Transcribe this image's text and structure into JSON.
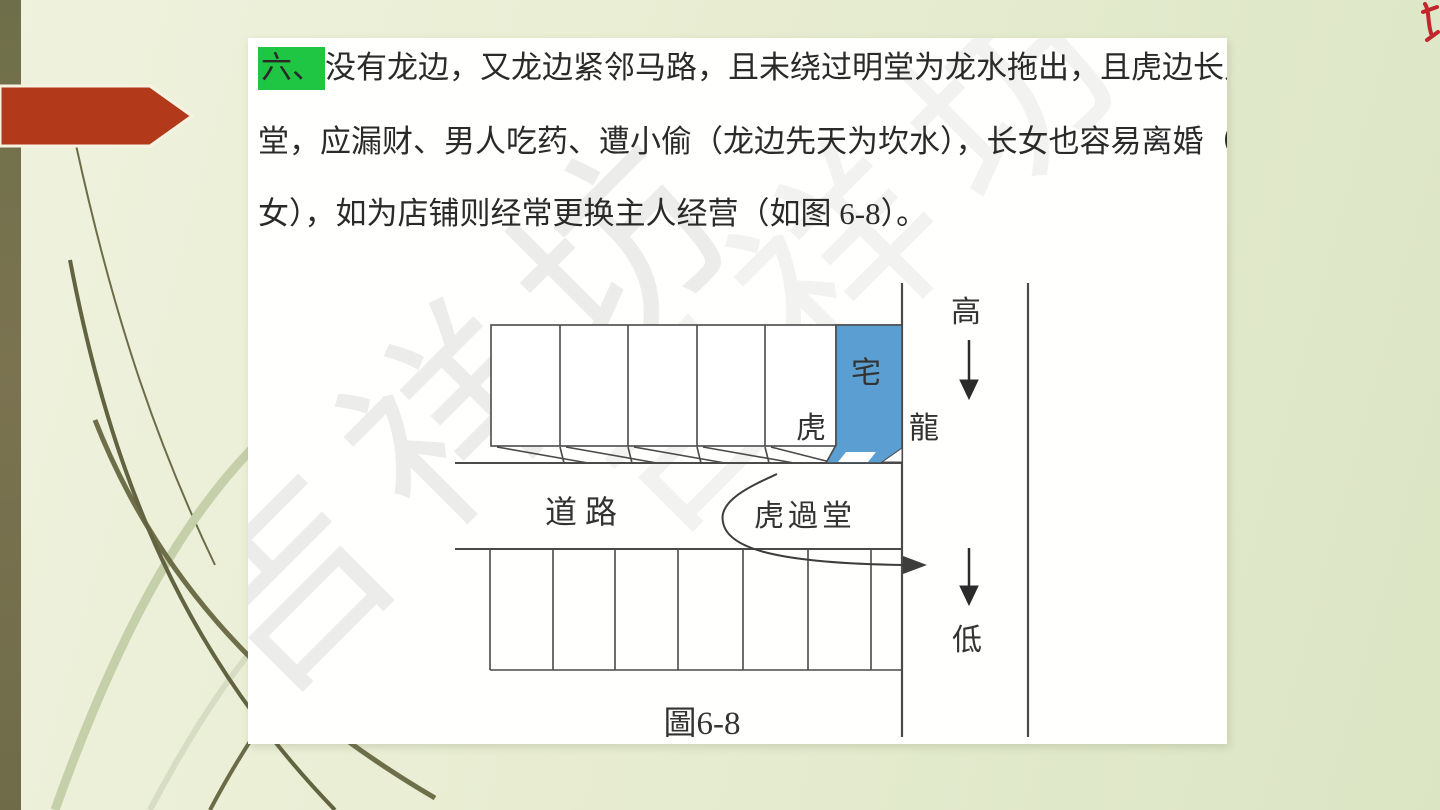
{
  "slide": {
    "type": "presentation-slide",
    "colors": {
      "background": "#e8edd2",
      "sidebar_bar": "#73734d",
      "accent_arrow": "#b23a1b",
      "panel": "#fffffd",
      "highlight_green": "#1fc643",
      "house_blue": "#5b9ed1",
      "body_text": "#2a2a2a",
      "diagram_line": "#4a4a4a",
      "watermark_gray": "#c9c9c9",
      "watermark_red": "#c1272d"
    }
  },
  "paragraph": {
    "highlight_text": "六、",
    "line1_rest": "没有龙边，又龙边紧邻马路，且未绕过明堂为龙水拖出，且虎边长又虎过",
    "line2": "堂，应漏财、男人吃药、遭小偷（龙边先天为坎水），长女也容易离婚（低论",
    "line3": "女），如为店铺则经常更换主人经营（如图 6-8）。"
  },
  "diagram": {
    "labels": {
      "house": "宅",
      "tiger": "虎",
      "dragon": "龍",
      "road": "道路",
      "tiger_passes_hall": "虎過堂",
      "high": "高",
      "low": "低",
      "caption": "圖6-8"
    },
    "top_row_units": 6,
    "bottom_row_units": 7,
    "house_fill": "#5b9ed1"
  },
  "watermark": {
    "text": "吉祥坊"
  }
}
